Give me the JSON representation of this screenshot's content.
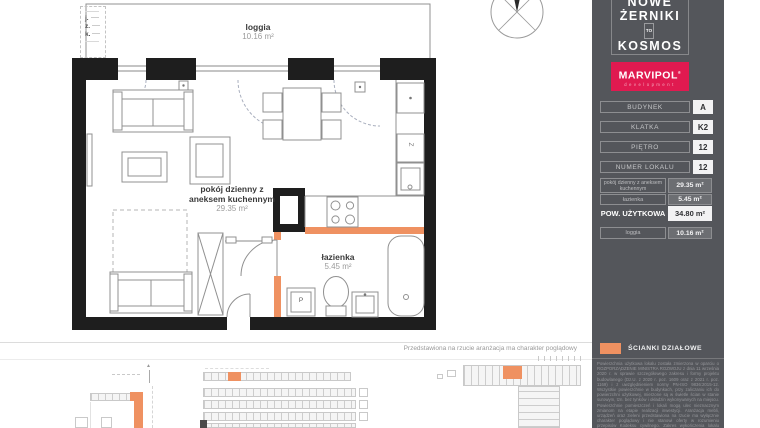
{
  "plan": {
    "legend_marks": [
      "j.",
      "z.",
      "k."
    ],
    "rooms": {
      "loggia": {
        "name": "loggia",
        "area": "10.16 m²"
      },
      "living": {
        "name_line1": "pokój dzienny z",
        "name_line2": "aneksem kuchennym",
        "area": "29.35 m²"
      },
      "bathroom": {
        "name": "łazienka",
        "area": "5.45 m²"
      }
    },
    "fixtures": {
      "washer": "P",
      "freezer": "Z"
    },
    "disclaimer": "Przedstawiona na rzucie aranżacja ma charakter poglądowy"
  },
  "sidebar": {
    "logo": {
      "line1": "NOWE",
      "line2": "ŻERNIKI",
      "to": "TO",
      "line3": "KOSMOS"
    },
    "developer": {
      "name": "MARVIPOL",
      "mark": "®",
      "sub": "development"
    },
    "rows": [
      {
        "label": "BUDYNEK",
        "value": "A"
      },
      {
        "label": "KLATKA",
        "value": "K2"
      },
      {
        "label": "PIĘTRO",
        "value": "12"
      },
      {
        "label": "NUMER LOKALU",
        "value": "12"
      }
    ],
    "areas": [
      {
        "label": "pokój dzienny z aneksem kuchennym",
        "value": "29.35 m²"
      },
      {
        "label": "łazienka",
        "value": "5.45 m²"
      }
    ],
    "total": {
      "label": "POW. UŻYTKOWA",
      "value": "34.80 m²"
    },
    "loggia_row": {
      "label": "loggia",
      "value": "10.16 m²"
    },
    "legend": {
      "label": "ŚCIANKI DZIAŁOWE"
    },
    "fine_print": "Powierzchnia użytkowa lokalu została zmierzona w oparciu o ROZPORZĄDZENIE MINISTRA ROZWOJU z dnia 11 września 2020 r. w sprawie szczegółowego zakresu i formy projektu budowlanego (Dz.U. z 2020 r. poz. 1609 oraz z 2021 r. poz. 1169) i z uwzględnieniem normy PN-ISO 9836:2015-12. Wszystkie powierzchnie w budynkach, przy zaliczaniu ich do powierzchni użytkowej, mierzone są w świetle ścian w stanie surowym, tzn. bez tynków i okładzin wykonywanych na miejscu. Powierzchnie pomieszczeń i lokali mogą ulec nieznacznym zmianom na etapie realizacji inwestycji. Aranżacja mebli, urządzeń oraz zieleni przedstawiona na rzucie ma wyłącznie charakter poglądowy i nie stanowi oferty w rozumieniu przepisów Kodeksu cywilnego. Zakres wykończenia lokalu określają prospekt informacyjny oraz załączniki do umowy deweloperskiej."
  },
  "colors": {
    "partition_orange": "#ef9161",
    "brand_crimson": "#e01a50",
    "sidebar_gray": "#54565b",
    "wall_black": "#1e1e1e"
  }
}
